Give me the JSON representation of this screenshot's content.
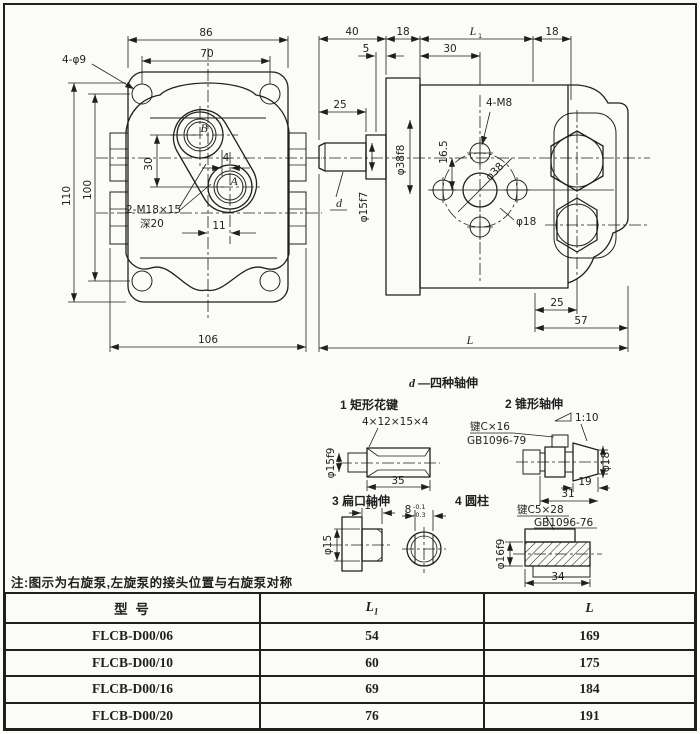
{
  "colors": {
    "ink": "#1f1f1f",
    "paper": "#fbfbf8"
  },
  "front_view": {
    "dim_flange_width": "86",
    "dim_hole_span": "70",
    "note_corner_holes": "4-φ9",
    "dim_height": "110",
    "dim_hole_height": "100",
    "dim_port_vertical": "30",
    "dim_port_offset": "4",
    "dim_port_horizontal": "11",
    "note_thread": "2-M18×15",
    "note_thread_depth": "深20",
    "dim_body_width": "106",
    "port_b": "B",
    "port_a": "A"
  },
  "side_view": {
    "dim_shaft_zone": "40",
    "dim_plate": "18",
    "dim_l1": "L",
    "dim_l1_sub": "1",
    "dim_rear": "18",
    "dim_step": "5",
    "dim_face_to_port": "30",
    "dim_shaft_len": "25",
    "note_mount_holes": "4-M8",
    "dim_axis_offset": "16.5",
    "dim_spigot": "φ38f8",
    "dim_shaft_dia": "φ15f7",
    "dim_port_circle": "φ38",
    "dim_plug": "φ18",
    "shaft_label": "d",
    "dim_rear_offset": "25",
    "dim_rear_len": "57",
    "dim_total": "L"
  },
  "shafts": {
    "title_d": "d",
    "title_rest": "—四种轴伸",
    "spline": {
      "label": "1 矩形花键",
      "spec": "4×12×15×4",
      "dia": "φ15f9",
      "len": "35"
    },
    "taper": {
      "label": "2 锥形轴伸",
      "key": "键C×16",
      "std": "GB1096-79",
      "taper": "1:10",
      "dia": "φ18",
      "len_taper": "19",
      "len_total": "31"
    },
    "flat": {
      "label": "3 扁口轴伸",
      "len": "10",
      "dia": "φ15",
      "width": "8",
      "tol_up": "-0.1",
      "tol_dn": "-0.3"
    },
    "cyl": {
      "label": "4 圆柱",
      "key": "键C5×28",
      "std": "GB1096-76",
      "dia": "φ16f9",
      "len": "34"
    }
  },
  "note": "注:图示为右旋泵,左旋泵的接头位置与右旋泵对称",
  "table": {
    "header_model": "型  号",
    "header_l1": "L",
    "header_l1_sub": "1",
    "header_l": "L",
    "rows": [
      {
        "model": "FLCB-D00/06",
        "l1": "54",
        "l": "169"
      },
      {
        "model": "FLCB-D00/10",
        "l1": "60",
        "l": "175"
      },
      {
        "model": "FLCB-D00/16",
        "l1": "69",
        "l": "184"
      },
      {
        "model": "FLCB-D00/20",
        "l1": "76",
        "l": "191"
      }
    ]
  }
}
